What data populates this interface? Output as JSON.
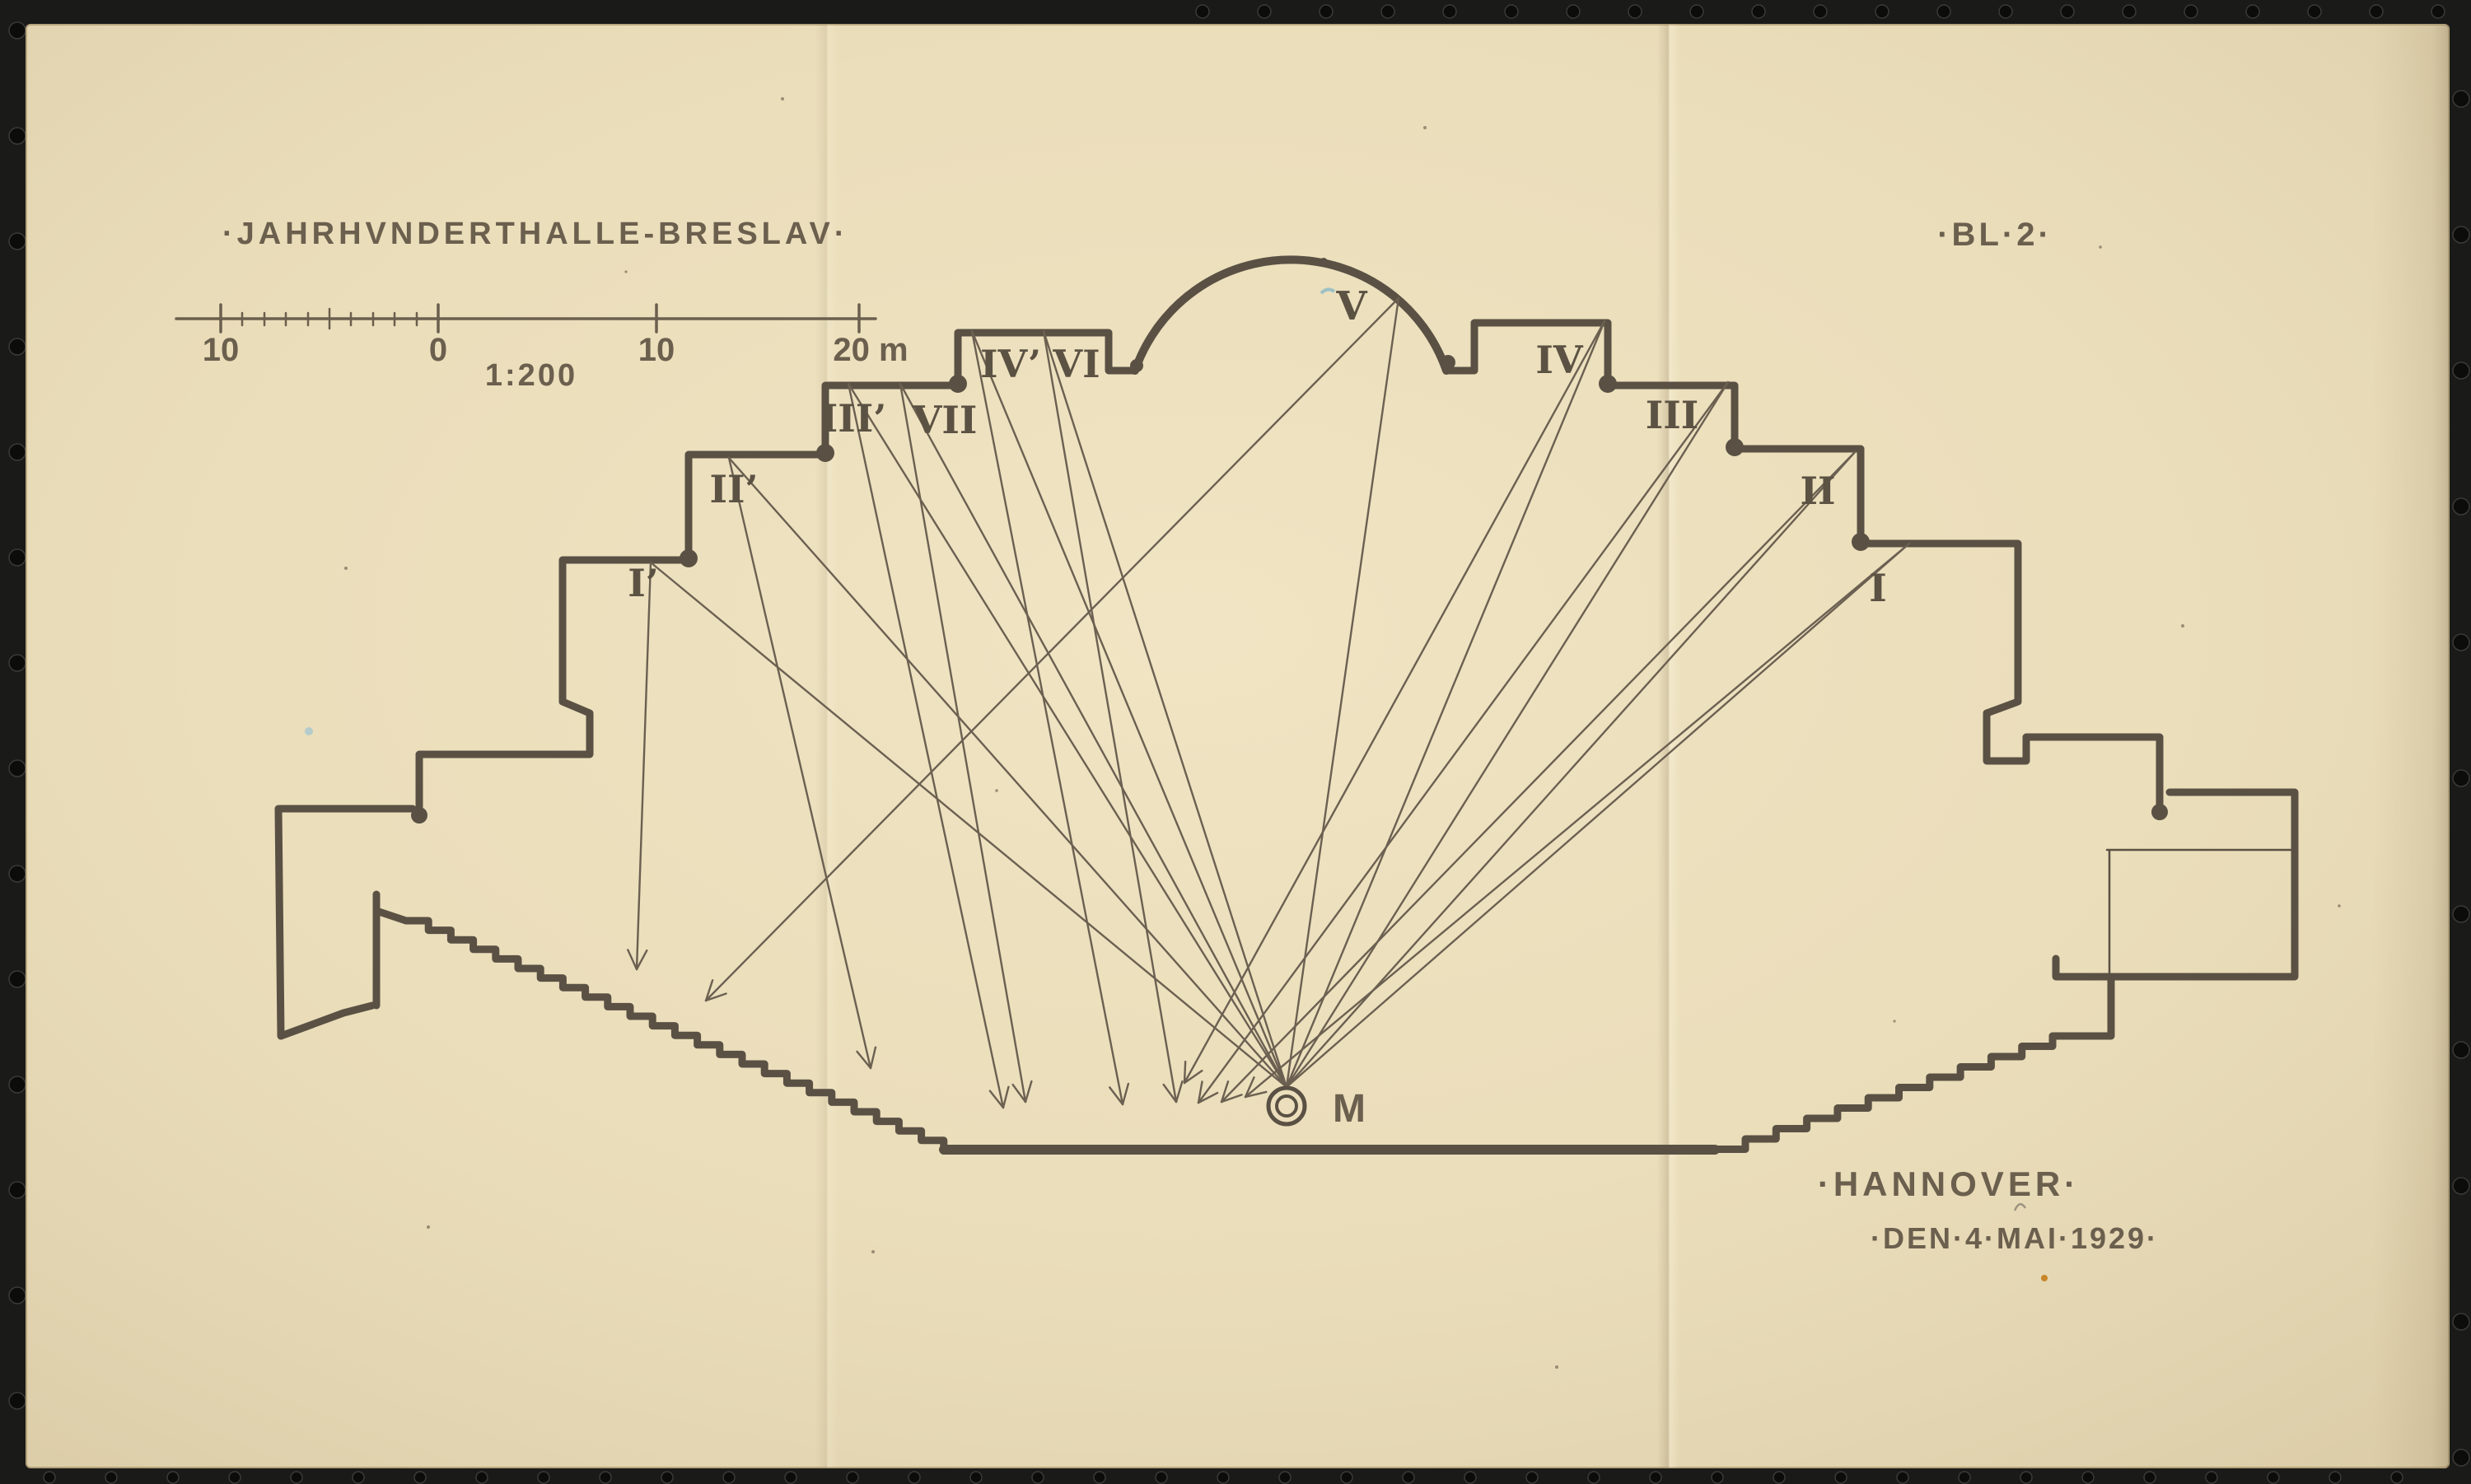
{
  "sheet": {
    "title": "·JAHRHVNDERTHALLE-BRESLAV·",
    "sheet_number": "·BL·2·",
    "place": "·HANNOVER·",
    "date": "·DEN·4·MAI·1929·"
  },
  "scale_bar": {
    "labels": [
      "10",
      "0",
      "10",
      "20 m"
    ],
    "ratio": "1:200"
  },
  "plan": {
    "point_label": "M",
    "bays": [
      "I’",
      "II’",
      "III’",
      "VII",
      "IV’",
      "VI",
      "V",
      "IV",
      "III",
      "II",
      "I"
    ]
  },
  "colors": {
    "paper": "#eaddba",
    "ink_wall": "#5a5144",
    "ink_ray": "#6b6051",
    "ink_text": "#6b5f4e",
    "film_background": "#1a1a18"
  }
}
